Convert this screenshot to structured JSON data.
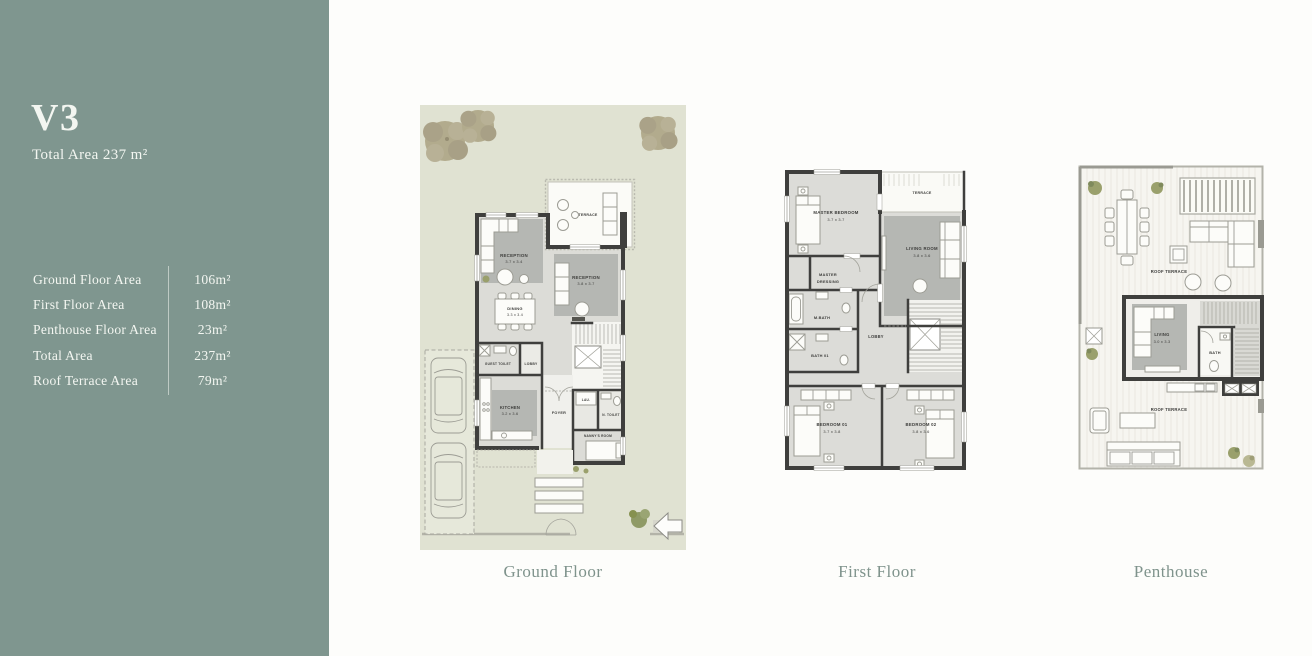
{
  "sidebar": {
    "unit_name": "V3",
    "total_area_line": "Total Area 237 m²",
    "area_table": {
      "rows": [
        {
          "label": "Ground Floor Area",
          "value": "106m²"
        },
        {
          "label": "First Floor Area",
          "value": "108m²"
        },
        {
          "label": "Penthouse Floor Area",
          "value": "23m²"
        },
        {
          "label": "Total Area",
          "value": "237m²"
        },
        {
          "label": "Roof Terrace Area",
          "value": "79m²"
        }
      ]
    }
  },
  "captions": {
    "ground": "Ground Floor",
    "first": "First Floor",
    "penthouse": "Penthouse"
  },
  "ground_floor": {
    "labels": {
      "terrace": "TERRACE",
      "reception_1": "RECEPTION",
      "reception_1_dims": "3.7 x 3.4",
      "reception_2": "RECEPTION",
      "reception_2_dims": "3.8 x 3.7",
      "dining": "DINING",
      "dining_dims": "3.3 x 3.4",
      "guest_toilet": "GUEST TOILET",
      "lobby": "LOBBY",
      "kitchen": "KITCHEN",
      "kitchen_dims": "3.2 x 3.6",
      "foyer": "FOYER",
      "laundry": "LAU.",
      "nanny_toilet": "N. TOILET",
      "nanny_room": "NANNY'S ROOM"
    }
  },
  "first_floor": {
    "labels": {
      "terrace": "TERRACE",
      "master_bedroom": "MASTER BEDROOM",
      "master_bedroom_dims": "3.7 x 3.7",
      "living_room": "LIVING ROOM",
      "living_room_dims": "3.8 x 3.6",
      "master_dressing_line1": "MASTER",
      "master_dressing_line2": "DRESSING",
      "master_bath": "M.BATH",
      "bath_01": "BATH 01",
      "lobby": "LOBBY",
      "bedroom_01": "BEDROOM 01",
      "bedroom_01_dims": "3.7 x 3.8",
      "bedroom_02": "BEDROOM 02",
      "bedroom_02_dims": "3.8 x 3.6"
    }
  },
  "penthouse": {
    "labels": {
      "roof_terrace_upper": "ROOF TERRACE",
      "living": "LIVING",
      "living_dims": "3.0 x 3.3",
      "bath": "BATH",
      "roof_terrace_lower": "ROOF TERRACE"
    }
  },
  "colors": {
    "sidebar_green": "#7f968f",
    "caption_green": "#7f938c",
    "garden": "#e0e2d2",
    "wall": "#3f3f3d",
    "carpet": "#b5b7b3"
  }
}
